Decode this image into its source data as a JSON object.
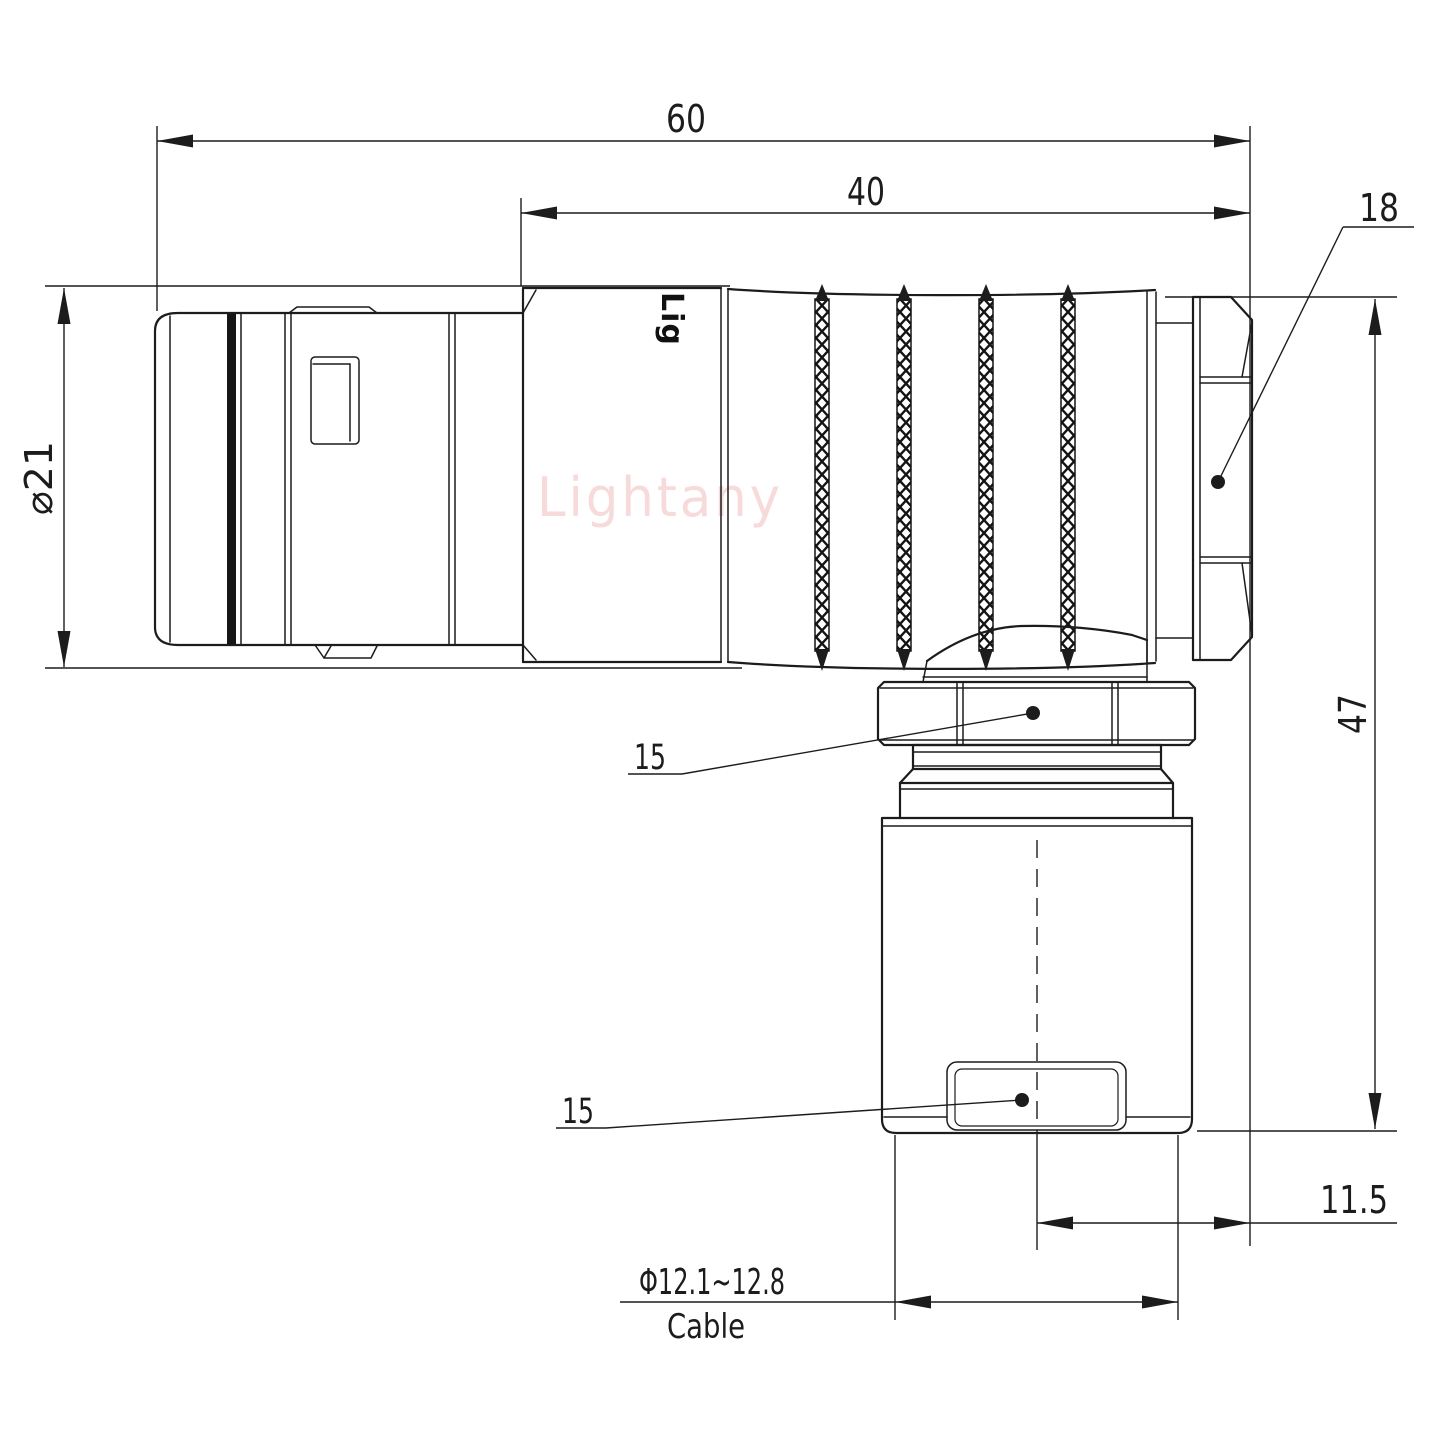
{
  "drawing": {
    "watermark": "Lightany",
    "shell_print": "Lig",
    "dims": {
      "overall_length": "60",
      "body_length": "40",
      "backnut_label": "18",
      "shell_diameter": "⌀21",
      "overall_height": "47",
      "coupling_nut_label": "15",
      "cable_clamp_label": "15",
      "exit_offset": "11.5",
      "cable_range": "Φ12.1~12.8",
      "cable_word": "Cable"
    },
    "colors": {
      "line": "#1c1c1c",
      "watermark": "#f0b6b6",
      "background": "#ffffff"
    }
  }
}
